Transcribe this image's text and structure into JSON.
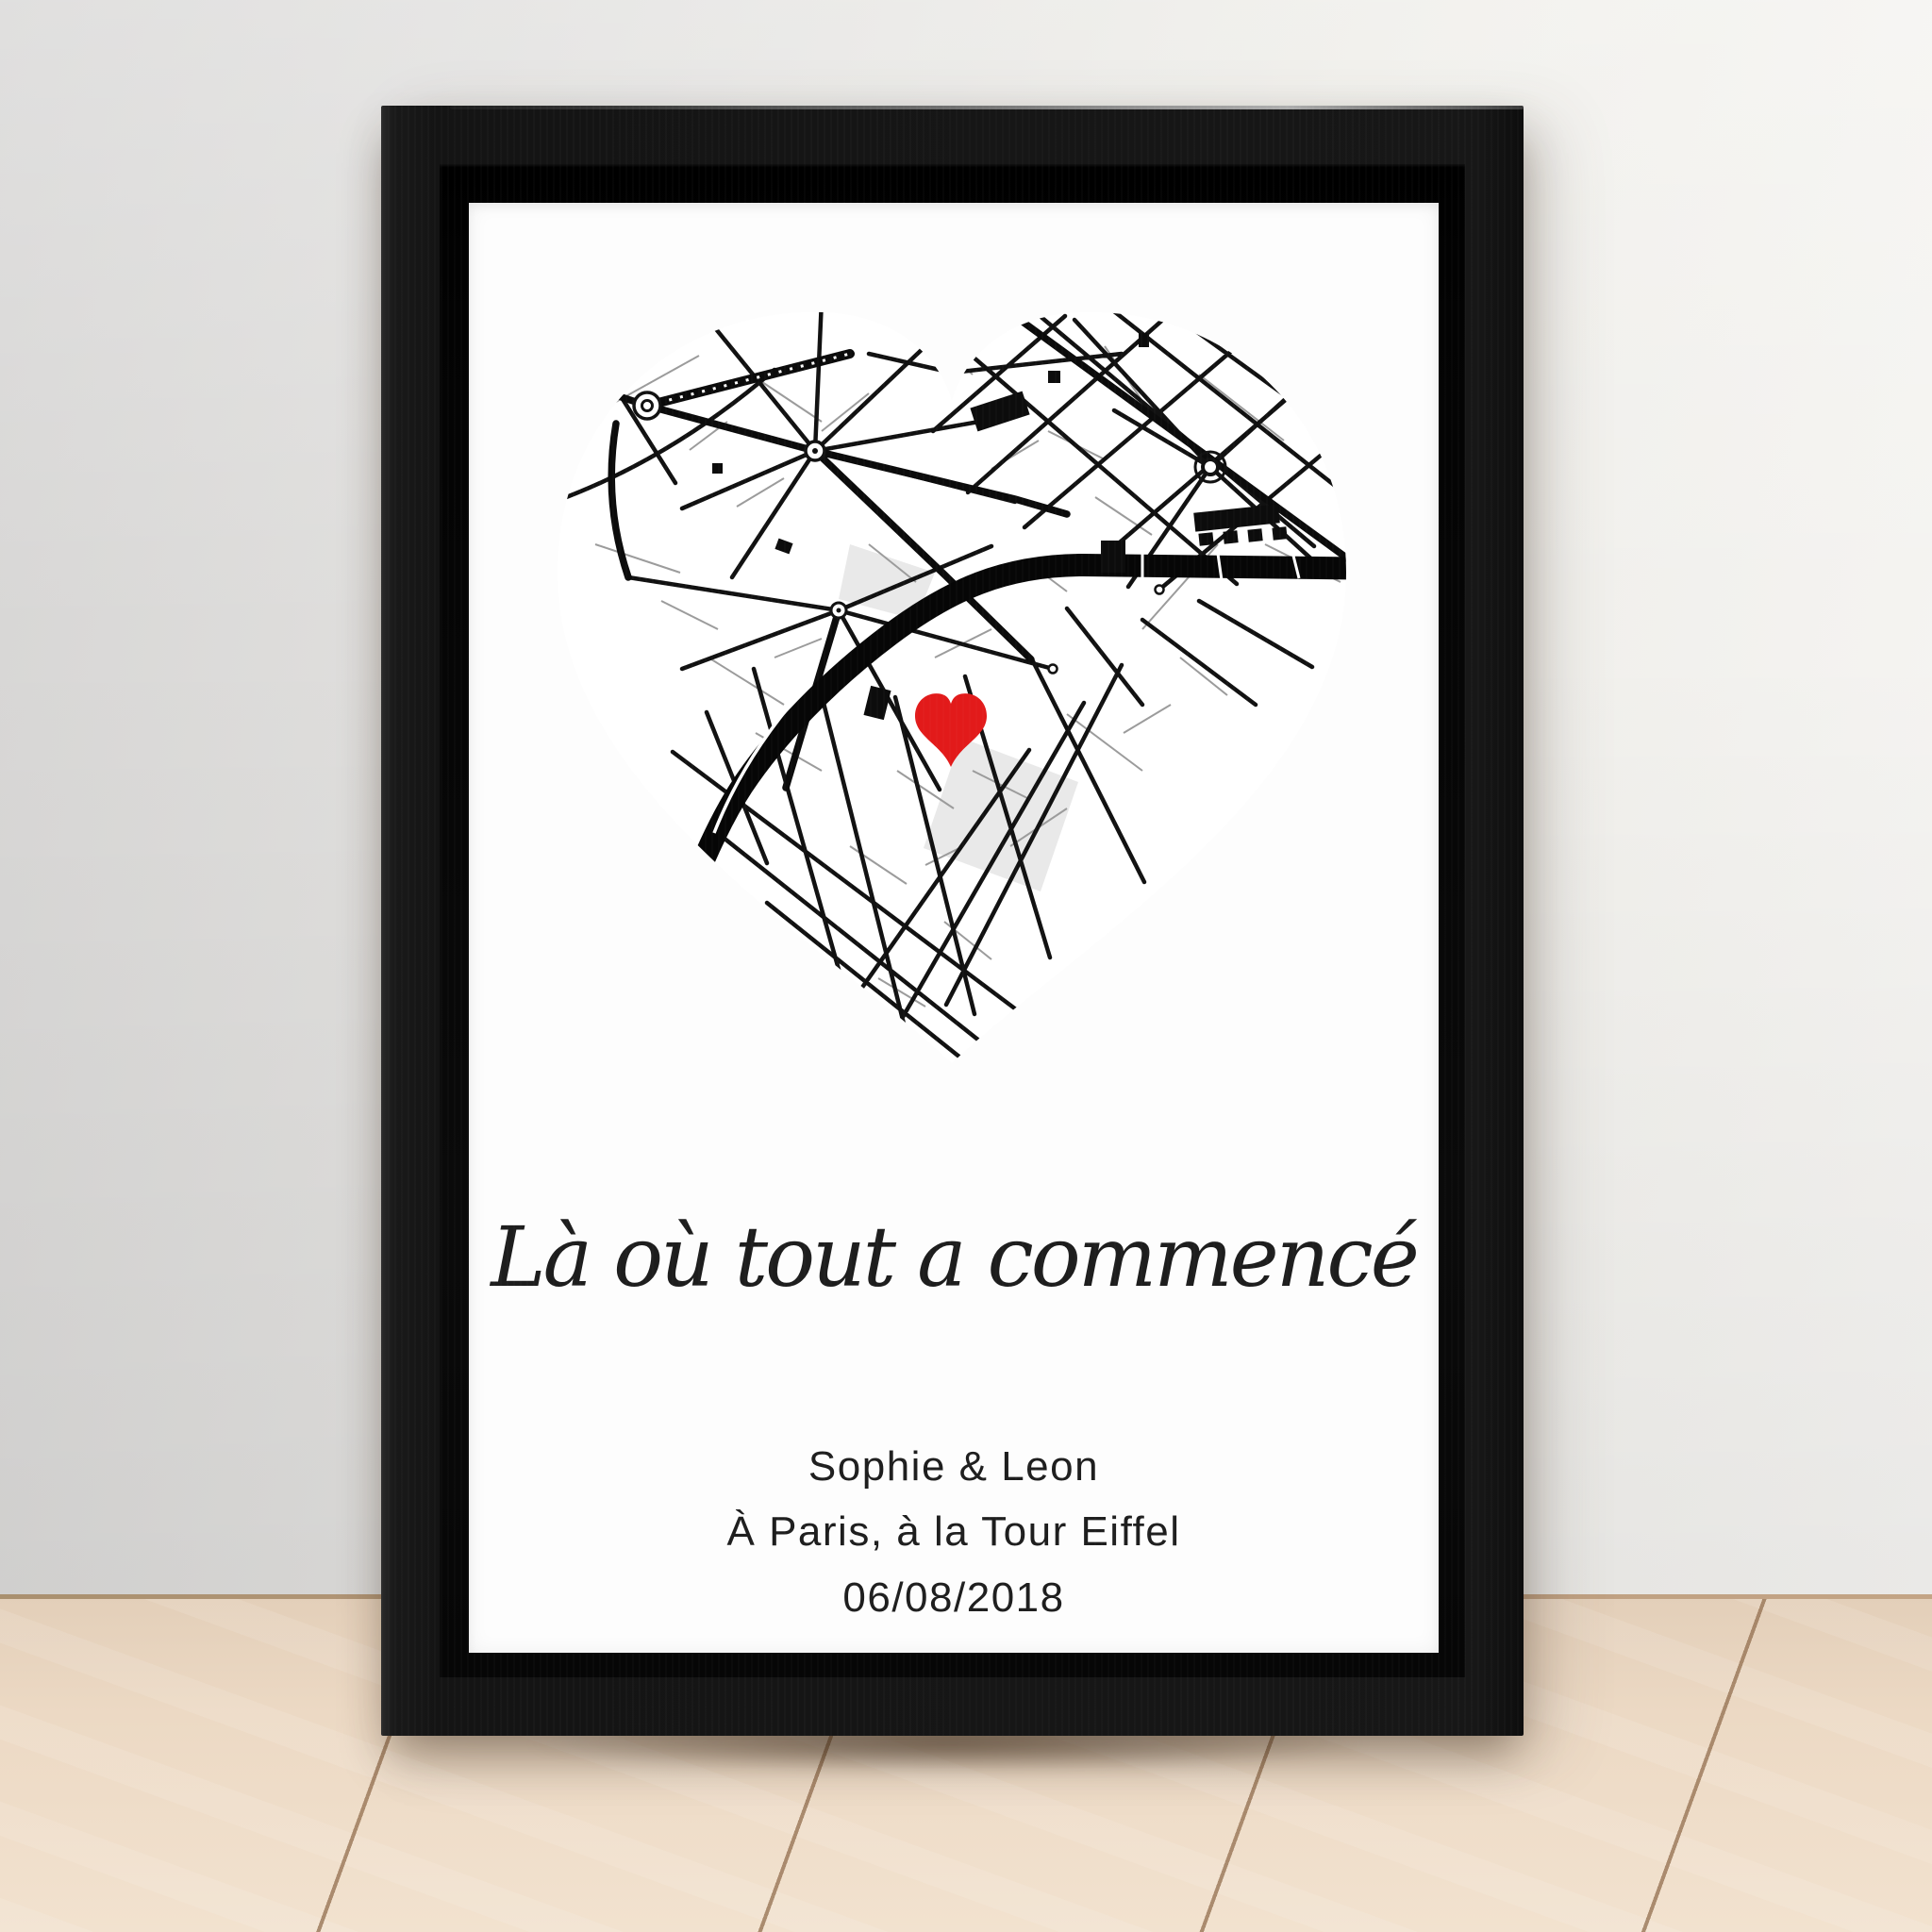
{
  "poster": {
    "quote": "Là où tout a commencé",
    "names": "Sophie & Leon",
    "location": "À Paris, à la Tour Eiffel",
    "date": "06/08/2018",
    "map": {
      "shape": "heart",
      "style": "black-and-white street map",
      "marker": "red heart at map location"
    }
  },
  "colors": {
    "heart_marker": "#e21a1a",
    "frame": "#141414",
    "canvas": "#fdfdfd",
    "map_streets": "#111111",
    "wall": "#e9e8e6",
    "floor": "#ecd9c4"
  }
}
